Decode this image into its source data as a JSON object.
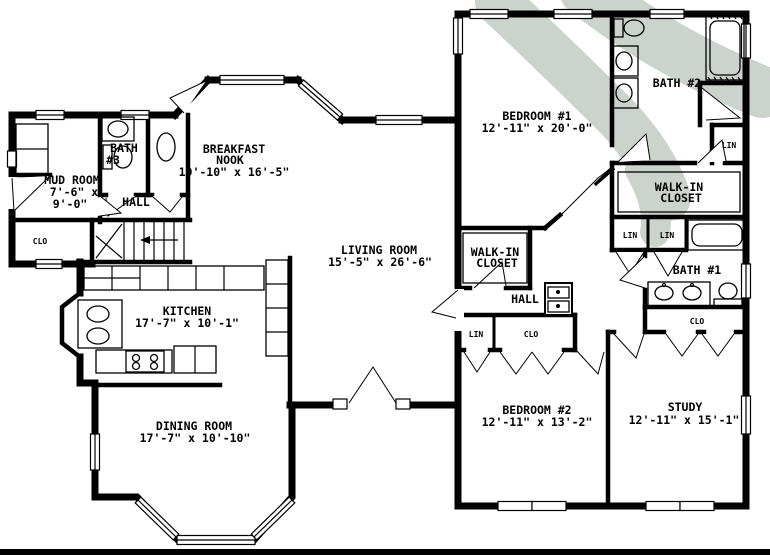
{
  "plan": {
    "rooms": {
      "mud_room": {
        "label": [
          "MUD ROOM",
          "7'-6\" x",
          "9'-0\""
        ]
      },
      "bath_3": {
        "label": [
          "BATH",
          "#3"
        ]
      },
      "hall_left": {
        "label": [
          "HALL"
        ]
      },
      "breakfast_nook": {
        "label": [
          "BREAKFAST",
          "NOOK",
          "10'-10\" x 16'-5\""
        ]
      },
      "living_room": {
        "label": [
          "LIVING ROOM",
          "15'-5\" x 26'-6\""
        ]
      },
      "kitchen": {
        "label": [
          "KITCHEN",
          "17'-7\" x 10'-1\""
        ]
      },
      "dining_room": {
        "label": [
          "DINING ROOM",
          "17'-7\" x 10'-10\""
        ]
      },
      "bedroom_1": {
        "label": [
          "BEDROOM #1",
          "12'-11\" x 20'-0\""
        ]
      },
      "bath_2": {
        "label": [
          "BATH #2"
        ]
      },
      "walk_in_right": {
        "label": [
          "WALK-IN",
          "CLOSET"
        ]
      },
      "walk_in_left": {
        "label": [
          "WALK-IN",
          "CLOSET"
        ]
      },
      "hall_right": {
        "label": [
          "HALL"
        ]
      },
      "bath_1": {
        "label": [
          "BATH #1"
        ]
      },
      "bedroom_2": {
        "label": [
          "BEDROOM #2",
          "12'-11\" x 13'-2\""
        ]
      },
      "study": {
        "label": [
          "STUDY",
          "12'-11\" x 15'-1\""
        ]
      }
    },
    "closet_labels": {
      "clo": "CLO",
      "lin": "LIN"
    },
    "colors": {
      "walls": "#000000",
      "background": "#ffffff",
      "watermark": "#ccd3cd"
    }
  }
}
